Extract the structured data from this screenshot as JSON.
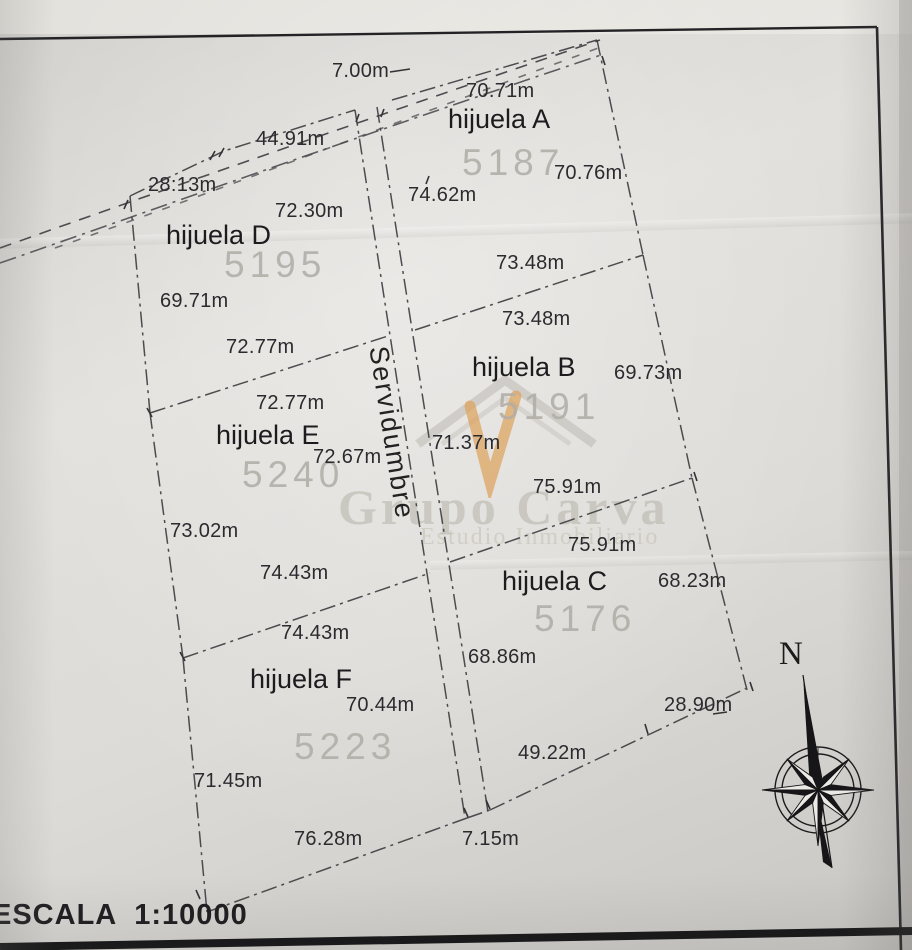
{
  "plan": {
    "scale": {
      "text": "ESCALA  1:10000"
    },
    "compass": {
      "north_label": "N"
    },
    "easement": {
      "label": "Servidumbre",
      "top_width": {
        "text": "7.00m",
        "x": 332,
        "y": 60
      },
      "bottom_width": {
        "text": "7.15m",
        "x": 462,
        "y": 828
      }
    },
    "watermark": {
      "brand": "Grupo Carva",
      "subtitle": "Estudio Inmobiliario",
      "icon": "house-with-check",
      "accent_color": "#dca25d"
    },
    "parcels": [
      {
        "id": "A",
        "name": "hijuela A",
        "number": "5187",
        "name_pos": {
          "x": 448,
          "y": 104
        },
        "number_pos": {
          "x": 462,
          "y": 142
        },
        "measurements": [
          {
            "text": "70.71m",
            "x": 466,
            "y": 80
          },
          {
            "text": "70.76m",
            "x": 554,
            "y": 162
          },
          {
            "text": "74.62m",
            "x": 408,
            "y": 184
          },
          {
            "text": "73.48m",
            "x": 496,
            "y": 252
          }
        ]
      },
      {
        "id": "B",
        "name": "hijuela B",
        "number": "5191",
        "name_pos": {
          "x": 472,
          "y": 352
        },
        "number_pos": {
          "x": 498,
          "y": 386
        },
        "measurements": [
          {
            "text": "73.48m",
            "x": 502,
            "y": 308
          },
          {
            "text": "69.73m",
            "x": 614,
            "y": 362
          },
          {
            "text": "71.37m",
            "x": 432,
            "y": 432
          },
          {
            "text": "75.91m",
            "x": 533,
            "y": 476
          }
        ]
      },
      {
        "id": "C",
        "name": "hijuela C",
        "number": "5176",
        "name_pos": {
          "x": 502,
          "y": 566
        },
        "number_pos": {
          "x": 534,
          "y": 598
        },
        "measurements": [
          {
            "text": "75.91m",
            "x": 568,
            "y": 534
          },
          {
            "text": "68.23m",
            "x": 658,
            "y": 570
          },
          {
            "text": "68.86m",
            "x": 468,
            "y": 646
          },
          {
            "text": "28.90m",
            "x": 664,
            "y": 694
          },
          {
            "text": "49.22m",
            "x": 518,
            "y": 742
          }
        ]
      },
      {
        "id": "D",
        "name": "hijuela D",
        "number": "5195",
        "name_pos": {
          "x": 166,
          "y": 220
        },
        "number_pos": {
          "x": 224,
          "y": 244
        },
        "measurements": [
          {
            "text": "44.91m",
            "x": 256,
            "y": 128
          },
          {
            "text": "28:13m",
            "x": 148,
            "y": 174
          },
          {
            "text": "72.30m",
            "x": 275,
            "y": 200
          },
          {
            "text": "69.71m",
            "x": 160,
            "y": 290
          },
          {
            "text": "72.77m",
            "x": 226,
            "y": 336
          }
        ]
      },
      {
        "id": "E",
        "name": "hijuela E",
        "number": "5240",
        "name_pos": {
          "x": 216,
          "y": 420
        },
        "number_pos": {
          "x": 242,
          "y": 454
        },
        "measurements": [
          {
            "text": "72.77m",
            "x": 256,
            "y": 392
          },
          {
            "text": "72.67m",
            "x": 313,
            "y": 446
          },
          {
            "text": "73.02m",
            "x": 170,
            "y": 520
          },
          {
            "text": "74.43m",
            "x": 260,
            "y": 562
          }
        ]
      },
      {
        "id": "F",
        "name": "hijuela F",
        "number": "5223",
        "name_pos": {
          "x": 250,
          "y": 664
        },
        "number_pos": {
          "x": 294,
          "y": 726
        },
        "measurements": [
          {
            "text": "74.43m",
            "x": 281,
            "y": 622
          },
          {
            "text": "70.44m",
            "x": 346,
            "y": 694
          },
          {
            "text": "71.45m",
            "x": 194,
            "y": 770
          },
          {
            "text": "76.28m",
            "x": 294,
            "y": 828
          }
        ]
      }
    ]
  }
}
